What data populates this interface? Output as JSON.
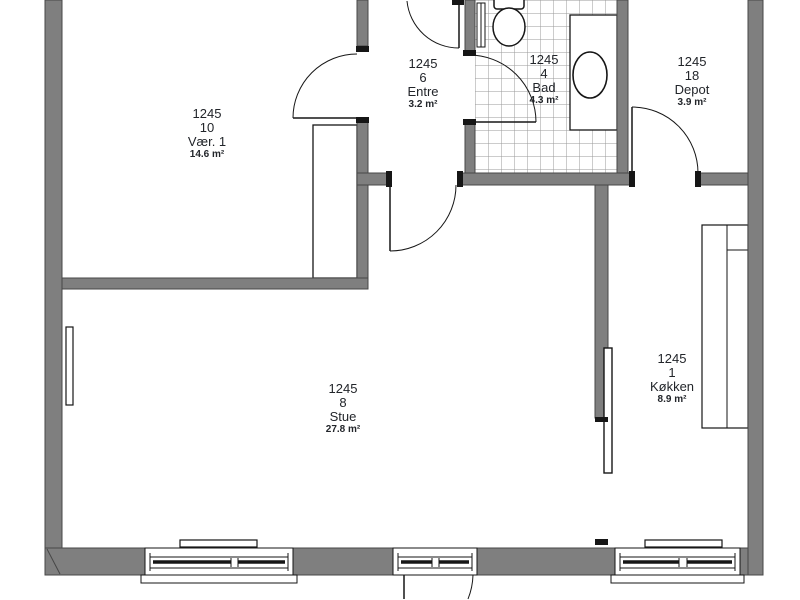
{
  "plan": {
    "title": "Apartment floor plan 1245",
    "rooms": [
      {
        "id": "vaer1",
        "unit": "1245",
        "room_no": "10",
        "name": "Vær. 1",
        "area": "14.6 m²"
      },
      {
        "id": "entre",
        "unit": "1245",
        "room_no": "6",
        "name": "Entre",
        "area": "3.2 m²"
      },
      {
        "id": "bad",
        "unit": "1245",
        "room_no": "4",
        "name": "Bad",
        "area": "4.3 m²"
      },
      {
        "id": "depot",
        "unit": "1245",
        "room_no": "18",
        "name": "Depot",
        "area": "3.9 m²"
      },
      {
        "id": "stue",
        "unit": "1245",
        "room_no": "8",
        "name": "Stue",
        "area": "27.8 m²"
      },
      {
        "id": "koekken",
        "unit": "1245",
        "room_no": "1",
        "name": "Køkken",
        "area": "8.9 m²"
      }
    ],
    "colors": {
      "background": "#ffffff",
      "wall_fill": "#7f7f7f",
      "wall_stroke": "#474747",
      "line": "#161616",
      "tile_line": "#9a9a9a",
      "label_text": "#22252a"
    }
  }
}
